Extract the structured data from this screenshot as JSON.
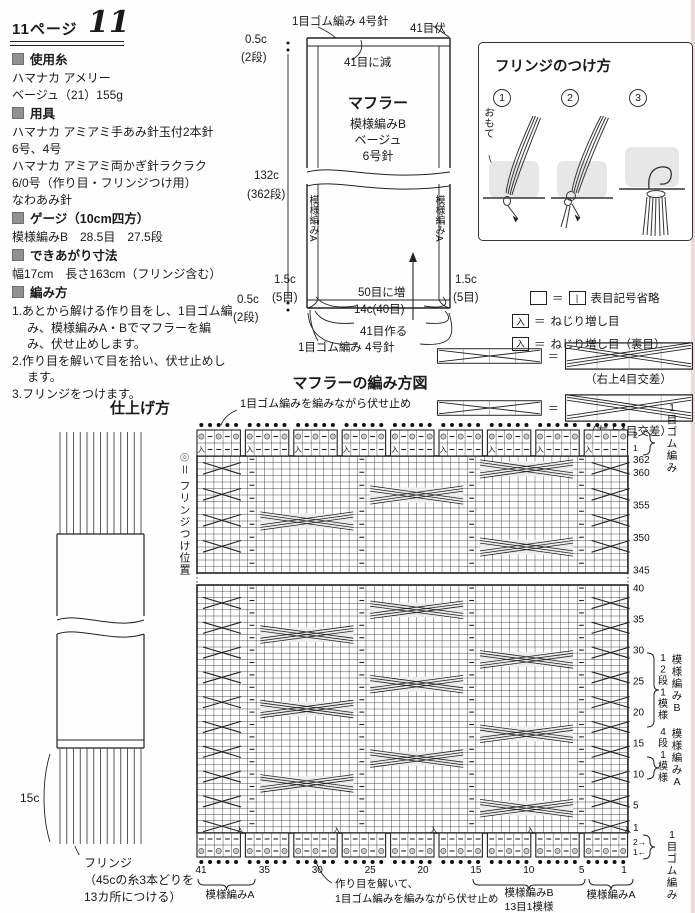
{
  "header": {
    "page_label": "11ページ",
    "number": "11"
  },
  "materials": {
    "yarn": {
      "header": "使用糸",
      "l0": "ハマナカ アメリー",
      "l1": "ベージュ（21）155g"
    },
    "tools": {
      "header": "用具",
      "l0": "ハマナカ アミアミ手あみ針玉付2本針",
      "l1": "6号、4号",
      "l2": "ハマナカ アミアミ両かぎ針ラクラク",
      "l3": "6/0号（作り目・フリンジつけ用）",
      "l4": "なわあみ針"
    },
    "gauge": {
      "header": "ゲージ（10cm四方）",
      "l0": "模様編みB　28.5目　27.5段"
    },
    "size": {
      "header": "できあがり寸法",
      "l0": "幅17cm　長さ163cm（フリンジ含む）"
    },
    "howto": {
      "header": "編み方",
      "s0": "1.あとから解ける作り目をし、1目ゴム編み、模様編みA・Bでマフラーを編み、伏せ止めします。",
      "s1": "2.作り目を解いて目を拾い、伏せ止めします。",
      "s2": "3.フリンジをつけます。"
    }
  },
  "schematic": {
    "rib_top": "1目ゴム編み 4号針",
    "bind_off": "41目伏",
    "decrease": "41目に減",
    "name": "マフラー",
    "pattern": "模様編みB",
    "color": "ベージュ",
    "needle": "6号針",
    "side_left": "模様編みA",
    "side_right": "模様編みA",
    "h_rib_top": "0.5c",
    "h_rib_top2": "(2段)",
    "h_body": "132c",
    "h_body2": "(362段)",
    "h_rib_bot": "0.5c",
    "h_rib_bot2": "(2段)",
    "side_l1": "1.5c",
    "side_l2": "(5目)",
    "side_r1": "1.5c",
    "side_r2": "(5目)",
    "inc": "50目に増",
    "width": "14c(40目)",
    "cast_on": "41目作る",
    "rib_bot": "1目ゴム編み 4号針"
  },
  "fringe": {
    "title": "フリンジのつけ方",
    "s1": "1",
    "s2": "2",
    "s3": "3",
    "front": "おもて"
  },
  "legend": {
    "r1_eq": "＝",
    "r1_ref": "|",
    "r1_text": "表目記号省略",
    "r2_sym": "入",
    "r2_eq": "＝",
    "r2_text": "ねじり増し目",
    "r3_sym": "入",
    "r3_eq": "＝",
    "r3_text": "ねじり増し目（裏目）",
    "c1_eq": "＝",
    "c1_cap": "（右上4目交差）",
    "c2_eq": "＝",
    "c2_cap": "（左上4目交差）"
  },
  "finishing": {
    "title": "仕上げ方",
    "len": "15c",
    "n0": "フリンジ",
    "n1": "（45cの糸3本どりを",
    "n2": "13カ所につける）",
    "pos_sym": "◎",
    "pos": "＝ フリンジつけ位置"
  },
  "chart": {
    "title": "マフラーの編み方図",
    "top_note": "1目ゴム編みを編みながら伏せ止め",
    "bottom_note": [
      "作り目を解いて、",
      "1目ゴム編みを編みながら伏せ止め"
    ],
    "rib_top_rows": [
      "2",
      "1"
    ],
    "rib_top_label": "1目ゴム編み",
    "upper_rows": [
      362,
      360,
      355,
      350,
      345
    ],
    "lower_rows": [
      40,
      35,
      30,
      25,
      20,
      15,
      10,
      5,
      1
    ],
    "rib_bottom_rows": [
      "2→",
      "1←"
    ],
    "rib_bottom_label": "1目ゴム編み",
    "patternB": {
      "repeat": "12段1模様",
      "name": "模様編みB"
    },
    "patternA": {
      "repeat": "4段1模様",
      "name": "模様編みA"
    },
    "cols": [
      41,
      35,
      30,
      25,
      20,
      15,
      10,
      5,
      1
    ],
    "bottom_left_bracket": "模様編みA",
    "bottom_mid_bracket": [
      "模様編みB",
      "13目1模様"
    ],
    "bottom_right_bracket": "模様編みA",
    "increase_symbol": "入"
  }
}
